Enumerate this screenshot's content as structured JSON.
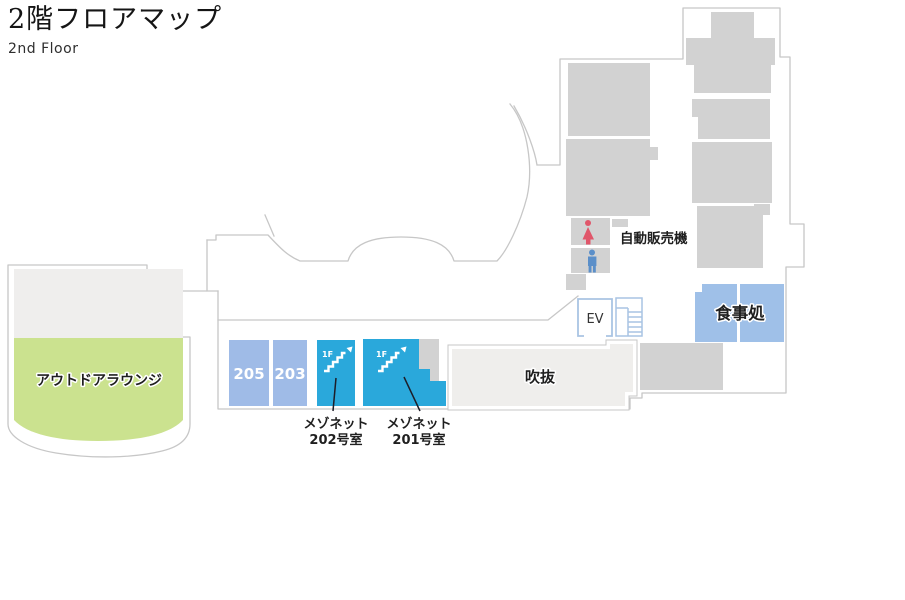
{
  "header": {
    "title": "2階フロアマップ",
    "subtitle": "2nd Floor"
  },
  "rooms": {
    "outdoor_lounge": {
      "label": "アウトドアラウンジ",
      "color": "#cbe28f"
    },
    "room_205": {
      "label": "205",
      "color": "#9fbbe7"
    },
    "room_203": {
      "label": "203",
      "color": "#9fbbe7"
    },
    "maisonette_202": {
      "floor_tag": "1F",
      "label_line1": "メゾネット",
      "label_line2": "202号室",
      "color": "#2aa8db"
    },
    "maisonette_201": {
      "floor_tag": "1F",
      "label_line1": "メゾネット",
      "label_line2": "201号室",
      "color": "#2aa8db"
    },
    "atrium": {
      "label": "吹抜",
      "color": "#efeeec"
    },
    "dining": {
      "label": "食事処",
      "color": "#9fc0e8"
    },
    "elevator": {
      "label": "EV"
    },
    "vending_machine": {
      "label": "自動販売機"
    }
  },
  "palette": {
    "wall_outline": "#c7c7c7",
    "room_gray": "#d2d2d2",
    "lounge_gray": "#efeeed",
    "female_icon": "#e0566a",
    "male_icon": "#5b8fc9",
    "ev_stair_blue": "#a9c4e3"
  }
}
